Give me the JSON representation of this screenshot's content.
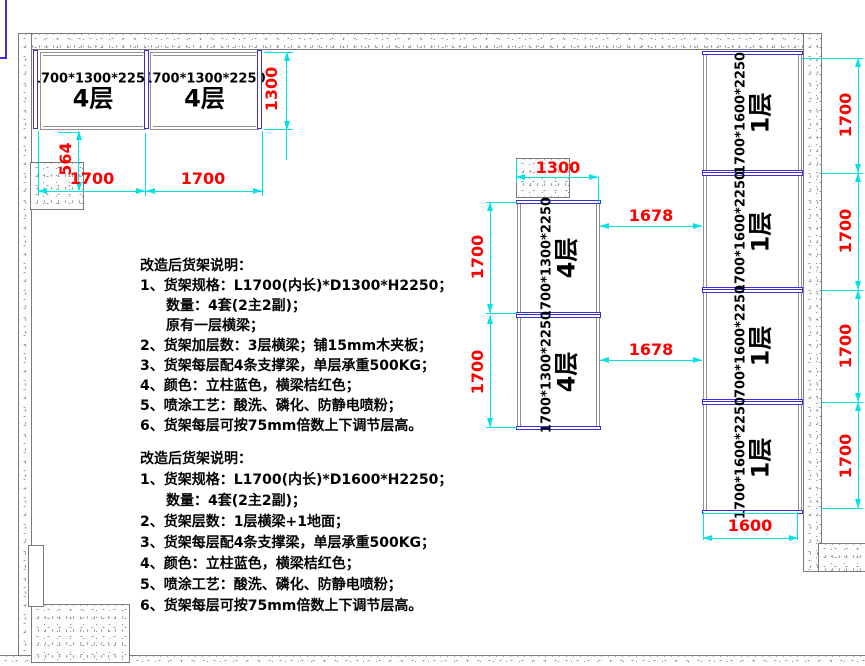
{
  "colors": {
    "dimension_text": "#FF0000",
    "dimension_line": "#00E3E3",
    "post_blue": "#3A2FD0",
    "rack_outline": "#8F8F8F"
  },
  "drawing": {
    "left_group": {
      "boxes": [
        {
          "size": "1700*1300*2250",
          "layers": "4层"
        },
        {
          "size": "1700*1300*2250",
          "layers": "4层"
        }
      ],
      "dims": {
        "depth": "1300",
        "offset": "564",
        "widths": [
          "1700",
          "1700"
        ]
      }
    },
    "mid_group": {
      "boxes": [
        {
          "size": "1700*1300*2250",
          "layers": "4层"
        },
        {
          "size": "1700*1300*2250",
          "layers": "4层"
        }
      ],
      "dims": {
        "top": "1300",
        "heights": [
          "1700",
          "1700"
        ],
        "gaps": [
          "1678",
          "1678"
        ]
      }
    },
    "right_group": {
      "boxes": [
        {
          "size": "1700*1600*2250",
          "layers": "1层"
        },
        {
          "size": "1700*1600*2250",
          "layers": "1层"
        },
        {
          "size": "1700*1600*2250",
          "layers": "1层"
        },
        {
          "size": "1700*1600*2250",
          "layers": "1层"
        }
      ],
      "dims": {
        "heights": [
          "1700",
          "1700",
          "1700",
          "1700"
        ],
        "width": "1600"
      }
    }
  },
  "notes_a": {
    "lines": [
      {
        "text": "改造后货架说明：",
        "indent": 0
      },
      {
        "text": "1、货架规格：L1700(内长)*D1300*H2250；",
        "indent": 0
      },
      {
        "text": "数量：4套(2主2副)；",
        "indent": 1
      },
      {
        "text": "原有一层横梁；",
        "indent": 1
      },
      {
        "text": "2、货架加层数：3层横梁；铺15mm木夹板；",
        "indent": 0
      },
      {
        "text": "3、货架每层配4条支撑梁，单层承重500KG；",
        "indent": 0
      },
      {
        "text": "4、颜色：立柱蓝色，横梁桔红色；",
        "indent": 0
      },
      {
        "text": "5、喷涂工艺：酸洗、磷化、防静电喷粉；",
        "indent": 0
      },
      {
        "text": "6、货架每层可按75mm倍数上下调节层高。",
        "indent": 0
      }
    ]
  },
  "notes_b": {
    "lines": [
      {
        "text": "改造后货架说明：",
        "indent": 0
      },
      {
        "text": "1、货架规格：L1700(内长)*D1600*H2250；",
        "indent": 0
      },
      {
        "text": "数量：4套(2主2副)；",
        "indent": 1
      },
      {
        "text": "2、货架层数：1层横梁+1地面；",
        "indent": 0
      },
      {
        "text": "3、货架每层配4条支撑梁，单层承重500KG；",
        "indent": 0
      },
      {
        "text": "4、颜色：立柱蓝色，横梁桔红色；",
        "indent": 0
      },
      {
        "text": "5、喷涂工艺：酸洗、磷化、防静电喷粉；",
        "indent": 0
      },
      {
        "text": "6、货架每层可按75mm倍数上下调节层高。",
        "indent": 0
      }
    ]
  }
}
